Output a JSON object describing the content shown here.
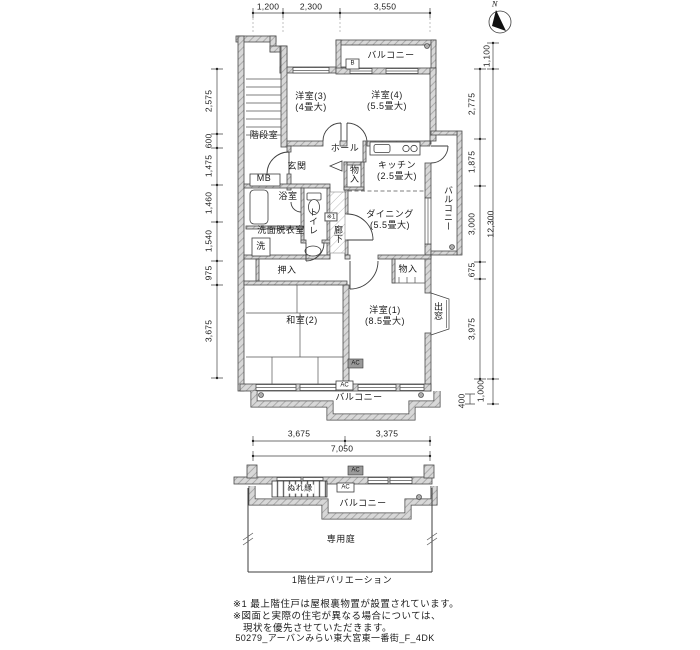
{
  "footer": "50279_アーバンみらい東大宮東一番街_F_4DK",
  "north": {
    "label": "N"
  },
  "dims": {
    "top": [
      "1,200",
      "2,300",
      "3,550"
    ],
    "left": [
      "2,575",
      "600",
      "1,475",
      "1,460",
      "1,540",
      "975",
      "3,675"
    ],
    "right_inner": [
      "2,775",
      "1,875",
      "3,000",
      "675",
      "3,975"
    ],
    "right_outer": [
      "1,100",
      "12,300",
      "1,000",
      "400"
    ],
    "bottom": [
      "3,675",
      "3,375"
    ],
    "bottom_total": "7,050"
  },
  "rooms": {
    "balcony_top": "バルコニー",
    "b_box": "B",
    "western3": {
      "name": "洋室(3)",
      "size": "(4畳大)"
    },
    "western4": {
      "name": "洋室(4)",
      "size": "(5.5畳大)"
    },
    "stairwell": "階段室",
    "hall": "ホール",
    "entrance": "玄関",
    "meter_box": "MB",
    "storage_hall": "物入",
    "kitchen": {
      "name": "キッチン",
      "size": "(2.5畳大)"
    },
    "balcony_right": "バルコニー",
    "bathroom": "浴室",
    "toilet": "トイレ",
    "washroom": "洗面脱衣室",
    "washer": "洗",
    "corridor": "廊下",
    "note_ref": "※1",
    "dining": {
      "name": "ダイニング",
      "size": "(5.5畳大)"
    },
    "oshiire": "押入",
    "storage_w1": "物入",
    "japanese2": "和室(2)",
    "western1": {
      "name": "洋室(1)",
      "size": "(8.5畳大)"
    },
    "bay_window": "出窓",
    "balcony_bottom": "バルコニー",
    "ac_label": "AC"
  },
  "lower_plan": {
    "nure_en": "ぬれ縁",
    "balcony": "バルコニー",
    "garden": "専用庭",
    "caption": "1階住戸バリエーション",
    "ac_label": "AC"
  },
  "notes": {
    "line1": "※1 最上階住戸は屋根裏物置が設置されています。",
    "line2": "※図面と実際の住宅が異なる場合については、",
    "line3": "現状を優先させていただきます。"
  }
}
